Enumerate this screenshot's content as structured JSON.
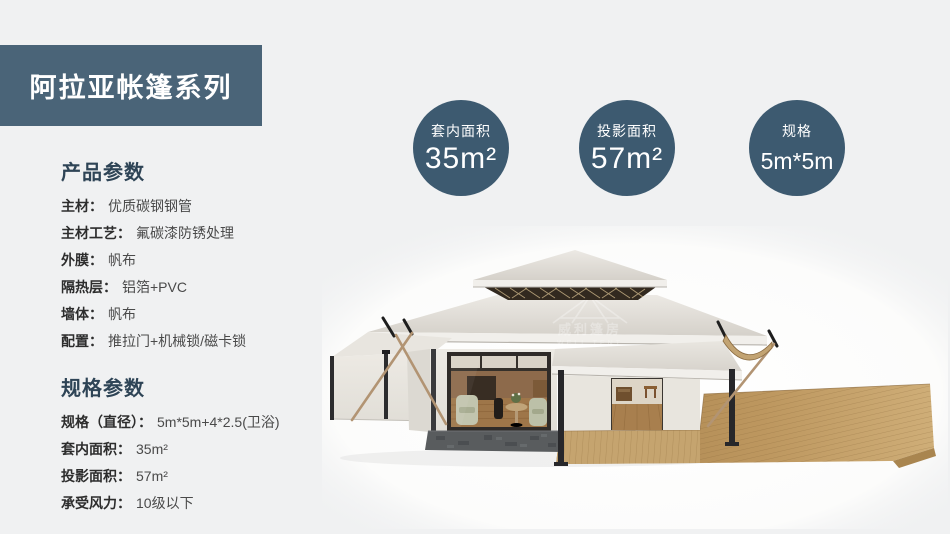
{
  "banner": {
    "title": "阿拉亚帐篷系列"
  },
  "product_params": {
    "heading": "产品参数",
    "items": [
      {
        "label": "主材：",
        "value": "优质碳钢钢管"
      },
      {
        "label": "主材工艺：",
        "value": "氟碳漆防锈处理"
      },
      {
        "label": "外膜：",
        "value": "帆布"
      },
      {
        "label": "隔热层：",
        "value": "铝箔+PVC"
      },
      {
        "label": "墙体：",
        "value": "帆布"
      },
      {
        "label": "配置：",
        "value": "推拉门+机械锁/磁卡锁"
      }
    ]
  },
  "spec_params": {
    "heading": "规格参数",
    "items": [
      {
        "label": "规格（直径）：",
        "value": "5m*5m+4*2.5(卫浴)"
      },
      {
        "label": "套内面积：",
        "value": "35m²"
      },
      {
        "label": "投影面积：",
        "value": "57m²"
      },
      {
        "label": "承受风力：",
        "value": "10级以下"
      }
    ]
  },
  "badges": [
    {
      "label": "套内面积",
      "value": "35m²"
    },
    {
      "label": "投影面积",
      "value": "57m²"
    },
    {
      "label": "规格",
      "value": "5m*5m"
    }
  ],
  "watermark": {
    "brand_cn": "威利篷房",
    "brand_en": "WELL TENT"
  },
  "colors": {
    "banner_bg": "#4a6478",
    "badge_bg": "#3d5a70",
    "heading": "#2e4456",
    "page_bg": "#f0f1f2"
  }
}
